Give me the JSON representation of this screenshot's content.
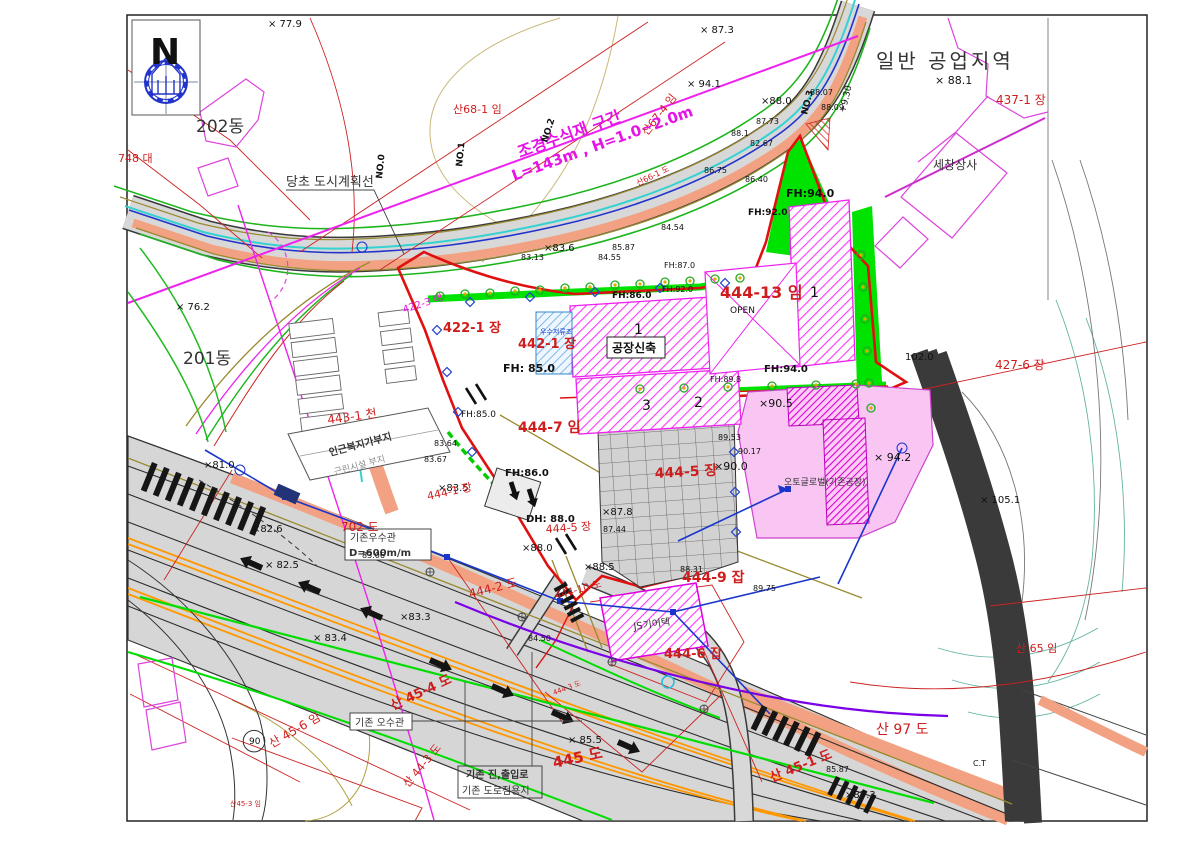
{
  "north_indicator": {
    "label": "N"
  },
  "colors": {
    "parcel_red": "#cf1d1d",
    "magenta": "#e613e6",
    "landscape_green": "#00e300",
    "road_gray": "#d6d6d6",
    "sidewalk_salmon": "#f2a283",
    "survey_blue": "#1a35cc",
    "stream_cyan": "#35d2d2",
    "boundary_olive": "#9a8a30",
    "utility_purple": "#7a00e6",
    "lane_orange": "#ff9800",
    "site_boundary_red": "#e01010",
    "factory_pink": "#f9c6f4"
  },
  "labels": [
    {
      "t": "N",
      "x": 150,
      "y": 64,
      "s": 36,
      "b": 1
    },
    {
      "t": "× 77.9",
      "x": 268,
      "y": 27,
      "s": 10
    },
    {
      "t": "× 87.3",
      "x": 700,
      "y": 33,
      "s": 10
    },
    {
      "t": "일반 공업지역",
      "x": 876,
      "y": 68,
      "s": 20,
      "c": "k2",
      "ls": 3
    },
    {
      "t": "× 88.1",
      "x": 935,
      "y": 84,
      "s": 11
    },
    {
      "t": "437-1 장",
      "x": 996,
      "y": 104,
      "c": "r",
      "s": 12
    },
    {
      "t": "세창상사",
      "x": 933,
      "y": 169,
      "s": 12,
      "c": "k2"
    },
    {
      "t": "202동",
      "x": 196,
      "y": 132,
      "s": 17,
      "c": "k2"
    },
    {
      "t": "748 대",
      "x": 118,
      "y": 162,
      "c": "r",
      "s": 11
    },
    {
      "t": "× 94.1",
      "x": 687,
      "y": 87,
      "s": 10
    },
    {
      "t": "×88.0",
      "x": 761,
      "y": 104,
      "s": 10
    },
    {
      "t": "+9.30",
      "x": 845,
      "y": 113,
      "s": 9,
      "r": -76
    },
    {
      "t": "NO.3",
      "x": 807,
      "y": 115,
      "s": 9,
      "r": -76,
      "b": 1
    },
    {
      "t": "88.07",
      "x": 810,
      "y": 95,
      "s": 8
    },
    {
      "t": "88.09",
      "x": 821,
      "y": 110,
      "s": 8
    },
    {
      "t": "87.73",
      "x": 756,
      "y": 124,
      "s": 8
    },
    {
      "t": "88.1",
      "x": 731,
      "y": 136,
      "s": 8
    },
    {
      "t": "82.67",
      "x": 750,
      "y": 146,
      "s": 8
    },
    {
      "t": "산68-1 임",
      "x": 453,
      "y": 113,
      "c": "r",
      "s": 11
    },
    {
      "t": "산67-4 임",
      "x": 647,
      "y": 136,
      "c": "r",
      "s": 11,
      "r": -52
    },
    {
      "t": "조경수식재 구간",
      "x": 520,
      "y": 158,
      "c": "m",
      "s": 16,
      "r": -20,
      "b": 1
    },
    {
      "t": "L=143m , H=1.0~2.0m",
      "x": 514,
      "y": 181,
      "c": "m",
      "s": 15,
      "r": -20,
      "b": 1
    },
    {
      "t": "당초 도시계획선",
      "x": 286,
      "y": 186,
      "s": 13,
      "c": "k2"
    },
    {
      "t": "NO.2",
      "x": 547,
      "y": 143,
      "s": 9,
      "r": -72,
      "b": 1
    },
    {
      "t": "NO.1",
      "x": 462,
      "y": 167,
      "s": 9,
      "r": -84,
      "b": 1
    },
    {
      "t": "NO.0",
      "x": 382,
      "y": 179,
      "s": 9,
      "r": -84,
      "b": 1
    },
    {
      "t": "산66-1 도",
      "x": 638,
      "y": 186,
      "c": "r",
      "s": 8,
      "r": -26
    },
    {
      "t": "86.75",
      "x": 704,
      "y": 173,
      "s": 8
    },
    {
      "t": "86.40",
      "x": 745,
      "y": 182,
      "s": 8
    },
    {
      "t": "84.54",
      "x": 661,
      "y": 230,
      "s": 8
    },
    {
      "t": "85.87",
      "x": 612,
      "y": 250,
      "s": 8
    },
    {
      "t": "FH:94.0",
      "x": 786,
      "y": 197,
      "s": 11,
      "b": 1
    },
    {
      "t": "FH:92.0",
      "x": 748,
      "y": 215,
      "s": 9,
      "b": 1
    },
    {
      "t": "×83.6",
      "x": 544,
      "y": 251,
      "s": 10
    },
    {
      "t": "83.13",
      "x": 521,
      "y": 260,
      "s": 8
    },
    {
      "t": "84.55",
      "x": 598,
      "y": 260,
      "s": 8
    },
    {
      "t": "FH:87.0",
      "x": 664,
      "y": 268,
      "s": 8
    },
    {
      "t": "FH:92.0",
      "x": 662,
      "y": 292,
      "s": 8
    },
    {
      "t": "FH:86.0",
      "x": 612,
      "y": 298,
      "s": 9,
      "b": 1
    },
    {
      "t": "× 76.2",
      "x": 176,
      "y": 310,
      "s": 10
    },
    {
      "t": "201동",
      "x": 183,
      "y": 364,
      "s": 17,
      "c": "k2"
    },
    {
      "t": "422-3 대",
      "x": 404,
      "y": 313,
      "c": "m",
      "s": 10,
      "r": -18
    },
    {
      "t": "422-1 장",
      "x": 443,
      "y": 332,
      "c": "r",
      "s": 13,
      "b": 1
    },
    {
      "t": "442-1 장",
      "x": 518,
      "y": 348,
      "c": "r",
      "s": 13,
      "b": 1
    },
    {
      "t": "우수저류조",
      "x": 540,
      "y": 334,
      "c": "b",
      "s": 7
    },
    {
      "t": "444-13 임",
      "x": 720,
      "y": 298,
      "c": "r",
      "s": 16,
      "b": 1
    },
    {
      "t": "OPEN",
      "x": 730,
      "y": 313,
      "s": 9
    },
    {
      "t": "1",
      "x": 634,
      "y": 334,
      "s": 14
    },
    {
      "t": "1",
      "x": 810,
      "y": 297,
      "s": 14
    },
    {
      "t": "3",
      "x": 642,
      "y": 410,
      "s": 14
    },
    {
      "t": "2",
      "x": 694,
      "y": 407,
      "s": 14
    },
    {
      "t": "공장신축",
      "x": 612,
      "y": 352,
      "s": 12,
      "b": 1,
      "bx": 1
    },
    {
      "t": "FH: 85.0",
      "x": 503,
      "y": 372,
      "s": 11,
      "b": 1
    },
    {
      "t": "FH:85.0",
      "x": 461,
      "y": 417,
      "s": 9
    },
    {
      "t": "FH:94.0",
      "x": 764,
      "y": 372,
      "s": 10,
      "b": 1
    },
    {
      "t": "FH:89.8",
      "x": 710,
      "y": 382,
      "s": 8
    },
    {
      "t": "102.0",
      "x": 905,
      "y": 360,
      "s": 10
    },
    {
      "t": "427-6 장",
      "x": 995,
      "y": 369,
      "c": "r",
      "s": 12
    },
    {
      "t": "×90.5",
      "x": 759,
      "y": 407,
      "s": 11
    },
    {
      "t": "443-1 천",
      "x": 328,
      "y": 424,
      "c": "r",
      "s": 12,
      "r": -8
    },
    {
      "t": "444-7 임",
      "x": 518,
      "y": 432,
      "c": "r",
      "s": 14,
      "b": 1
    },
    {
      "t": "83.64",
      "x": 434,
      "y": 446,
      "s": 8
    },
    {
      "t": "83.67",
      "x": 424,
      "y": 462,
      "s": 8
    },
    {
      "t": "89.53",
      "x": 718,
      "y": 440,
      "s": 8
    },
    {
      "t": "90.17",
      "x": 738,
      "y": 454,
      "s": 8
    },
    {
      "t": "인근복지가부지",
      "x": 330,
      "y": 456,
      "s": 10,
      "r": -15,
      "c": "k2",
      "b": 1
    },
    {
      "t": "근린시설 부지",
      "x": 335,
      "y": 475,
      "s": 9,
      "r": -15,
      "c": "gr"
    },
    {
      "t": "×90.0",
      "x": 714,
      "y": 470,
      "s": 11
    },
    {
      "t": "× 94.2",
      "x": 874,
      "y": 461,
      "s": 11
    },
    {
      "t": "444-5 장",
      "x": 655,
      "y": 478,
      "c": "r",
      "s": 14,
      "b": 1,
      "r": -3
    },
    {
      "t": "오토글로벌(기존공장)",
      "x": 784,
      "y": 485,
      "s": 9,
      "c": "k2"
    },
    {
      "t": "×83.5",
      "x": 438,
      "y": 491,
      "s": 10
    },
    {
      "t": "444-1 장",
      "x": 428,
      "y": 500,
      "c": "r",
      "s": 11,
      "r": -12
    },
    {
      "t": "× 105.1",
      "x": 980,
      "y": 503,
      "s": 10
    },
    {
      "t": "×81.0",
      "x": 204,
      "y": 468,
      "s": 10
    },
    {
      "t": "FH:86.0",
      "x": 505,
      "y": 476,
      "s": 10,
      "b": 1
    },
    {
      "t": "×87.8",
      "x": 602,
      "y": 515,
      "s": 10
    },
    {
      "t": "87.44",
      "x": 603,
      "y": 532,
      "s": 8
    },
    {
      "t": "DH: 88.0",
      "x": 526,
      "y": 522,
      "s": 10,
      "b": 1
    },
    {
      "t": "702 도",
      "x": 341,
      "y": 531,
      "c": "r",
      "s": 12
    },
    {
      "t": "기존우수관",
      "x": 350,
      "y": 541,
      "s": 10,
      "c": "k2"
    },
    {
      "t": "D=600m/m",
      "x": 349,
      "y": 556,
      "s": 10,
      "c": "k2",
      "b": 1
    },
    {
      "t": "444-5 장",
      "x": 546,
      "y": 533,
      "c": "r",
      "s": 11,
      "r": -4
    },
    {
      "t": "×88.0",
      "x": 522,
      "y": 551,
      "s": 10
    },
    {
      "t": "×82.6",
      "x": 252,
      "y": 532,
      "s": 10
    },
    {
      "t": "× 82.5",
      "x": 265,
      "y": 568,
      "s": 10
    },
    {
      "t": "83.06",
      "x": 362,
      "y": 558,
      "s": 8
    },
    {
      "t": "×88.5",
      "x": 584,
      "y": 570,
      "s": 10
    },
    {
      "t": "88.31",
      "x": 680,
      "y": 572,
      "s": 8
    },
    {
      "t": "444-9 잡",
      "x": 682,
      "y": 582,
      "c": "r",
      "s": 14,
      "b": 1
    },
    {
      "t": "89.75",
      "x": 753,
      "y": 591,
      "s": 8
    },
    {
      "t": "444-2 도",
      "x": 470,
      "y": 598,
      "c": "r",
      "s": 12,
      "r": -14
    },
    {
      "t": "444-10 도",
      "x": 556,
      "y": 599,
      "c": "r",
      "s": 10,
      "r": -15
    },
    {
      "t": "84.50",
      "x": 528,
      "y": 641,
      "s": 8
    },
    {
      "t": "×83.3",
      "x": 400,
      "y": 620,
      "s": 10
    },
    {
      "t": "× 83.4",
      "x": 313,
      "y": 641,
      "s": 10
    },
    {
      "t": "JS기어텍",
      "x": 634,
      "y": 630,
      "s": 10,
      "r": -8,
      "c": "k2"
    },
    {
      "t": "444-6 잡",
      "x": 664,
      "y": 658,
      "c": "r",
      "s": 13,
      "b": 1
    },
    {
      "t": "산 65 임",
      "x": 1016,
      "y": 652,
      "c": "r",
      "s": 11
    },
    {
      "t": "산 45-4 도",
      "x": 393,
      "y": 710,
      "c": "r",
      "s": 13,
      "r": -25,
      "b": 1
    },
    {
      "t": "기존 오수관",
      "x": 355,
      "y": 726,
      "s": 10,
      "c": "k2"
    },
    {
      "t": "90",
      "x": 249,
      "y": 744,
      "s": 9,
      "circ": 1
    },
    {
      "t": "산 45-6 임",
      "x": 272,
      "y": 748,
      "c": "r",
      "s": 12,
      "r": -30
    },
    {
      "t": "444-3 도",
      "x": 554,
      "y": 695,
      "c": "r",
      "s": 7,
      "r": -20
    },
    {
      "t": "× 85.5",
      "x": 568,
      "y": 743,
      "s": 10
    },
    {
      "t": "445 도",
      "x": 554,
      "y": 768,
      "c": "r",
      "s": 15,
      "r": -12,
      "b": 1
    },
    {
      "t": "기존 진,출입로",
      "x": 466,
      "y": 778,
      "s": 10,
      "c": "k2",
      "b": 1
    },
    {
      "t": "기존 도로점용지",
      "x": 462,
      "y": 794,
      "s": 10,
      "c": "k2"
    },
    {
      "t": "산 44-3 도",
      "x": 408,
      "y": 788,
      "c": "r",
      "s": 11,
      "r": -50
    },
    {
      "t": "산45-3 임",
      "x": 230,
      "y": 806,
      "c": "r",
      "s": 7
    },
    {
      "t": "산 97 도",
      "x": 876,
      "y": 734,
      "c": "r",
      "s": 14
    },
    {
      "t": "85.87",
      "x": 826,
      "y": 772,
      "s": 8
    },
    {
      "t": "×87.3",
      "x": 845,
      "y": 798,
      "s": 10
    },
    {
      "t": "산 45-1 도",
      "x": 772,
      "y": 782,
      "c": "r",
      "s": 13,
      "r": -22,
      "b": 1
    },
    {
      "t": "C.T",
      "x": 973,
      "y": 766,
      "s": 8
    }
  ]
}
